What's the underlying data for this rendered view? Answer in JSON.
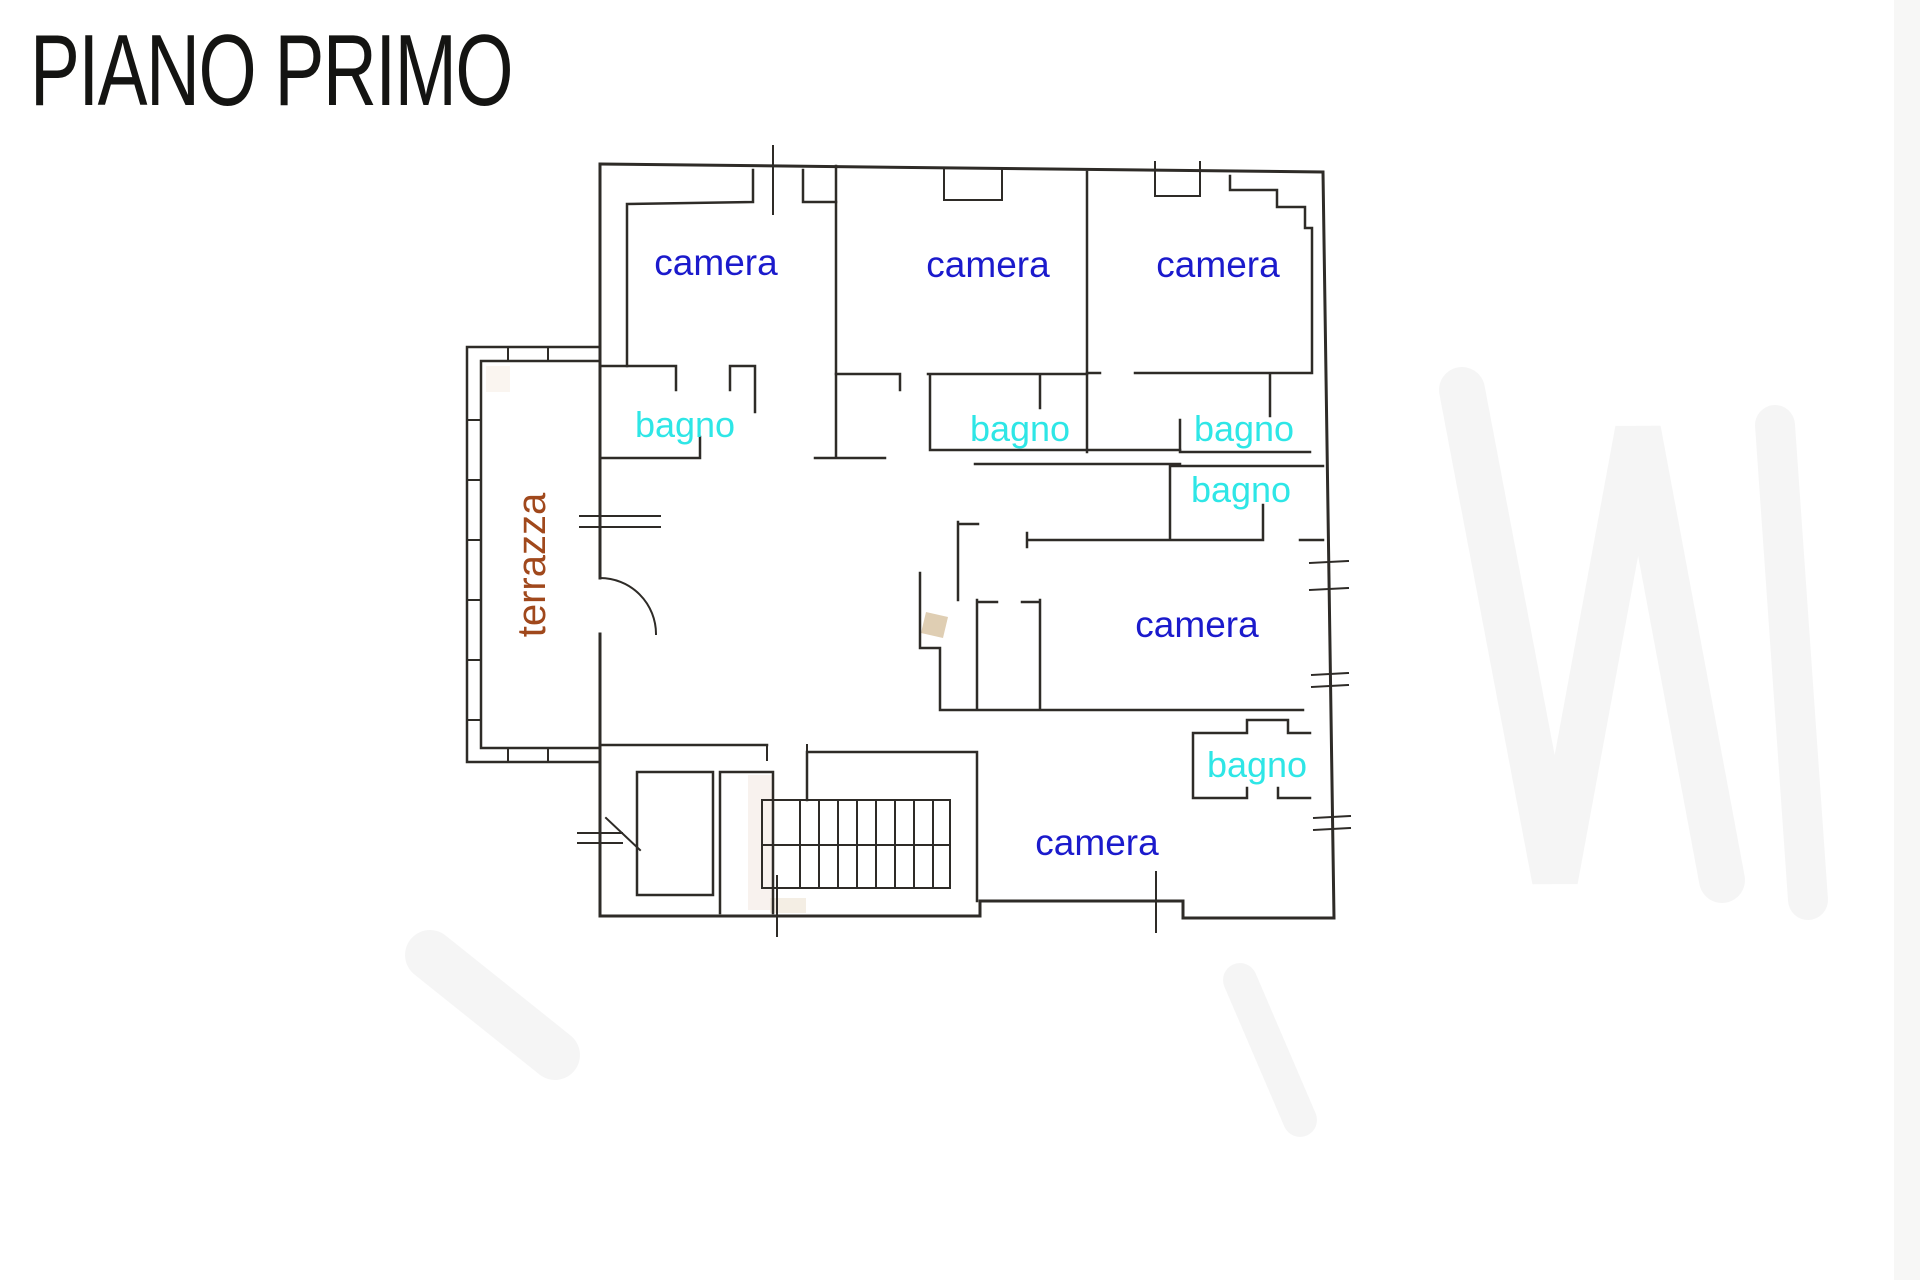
{
  "title": "PIANO PRIMO",
  "rooms": {
    "camera_1": "camera",
    "camera_2": "camera",
    "camera_3": "camera",
    "camera_4": "camera",
    "camera_5": "camera",
    "bagno_1": "bagno",
    "bagno_2": "bagno",
    "bagno_3": "bagno",
    "bagno_4": "bagno",
    "bagno_5": "bagno",
    "terrazza": "terrazza"
  },
  "colors": {
    "camera_label": "#1b1acc",
    "bagno_label": "#2ee6e6",
    "terrazza_label": "#a0481c",
    "walls": "#2e2b27",
    "background": "#ffffff"
  }
}
